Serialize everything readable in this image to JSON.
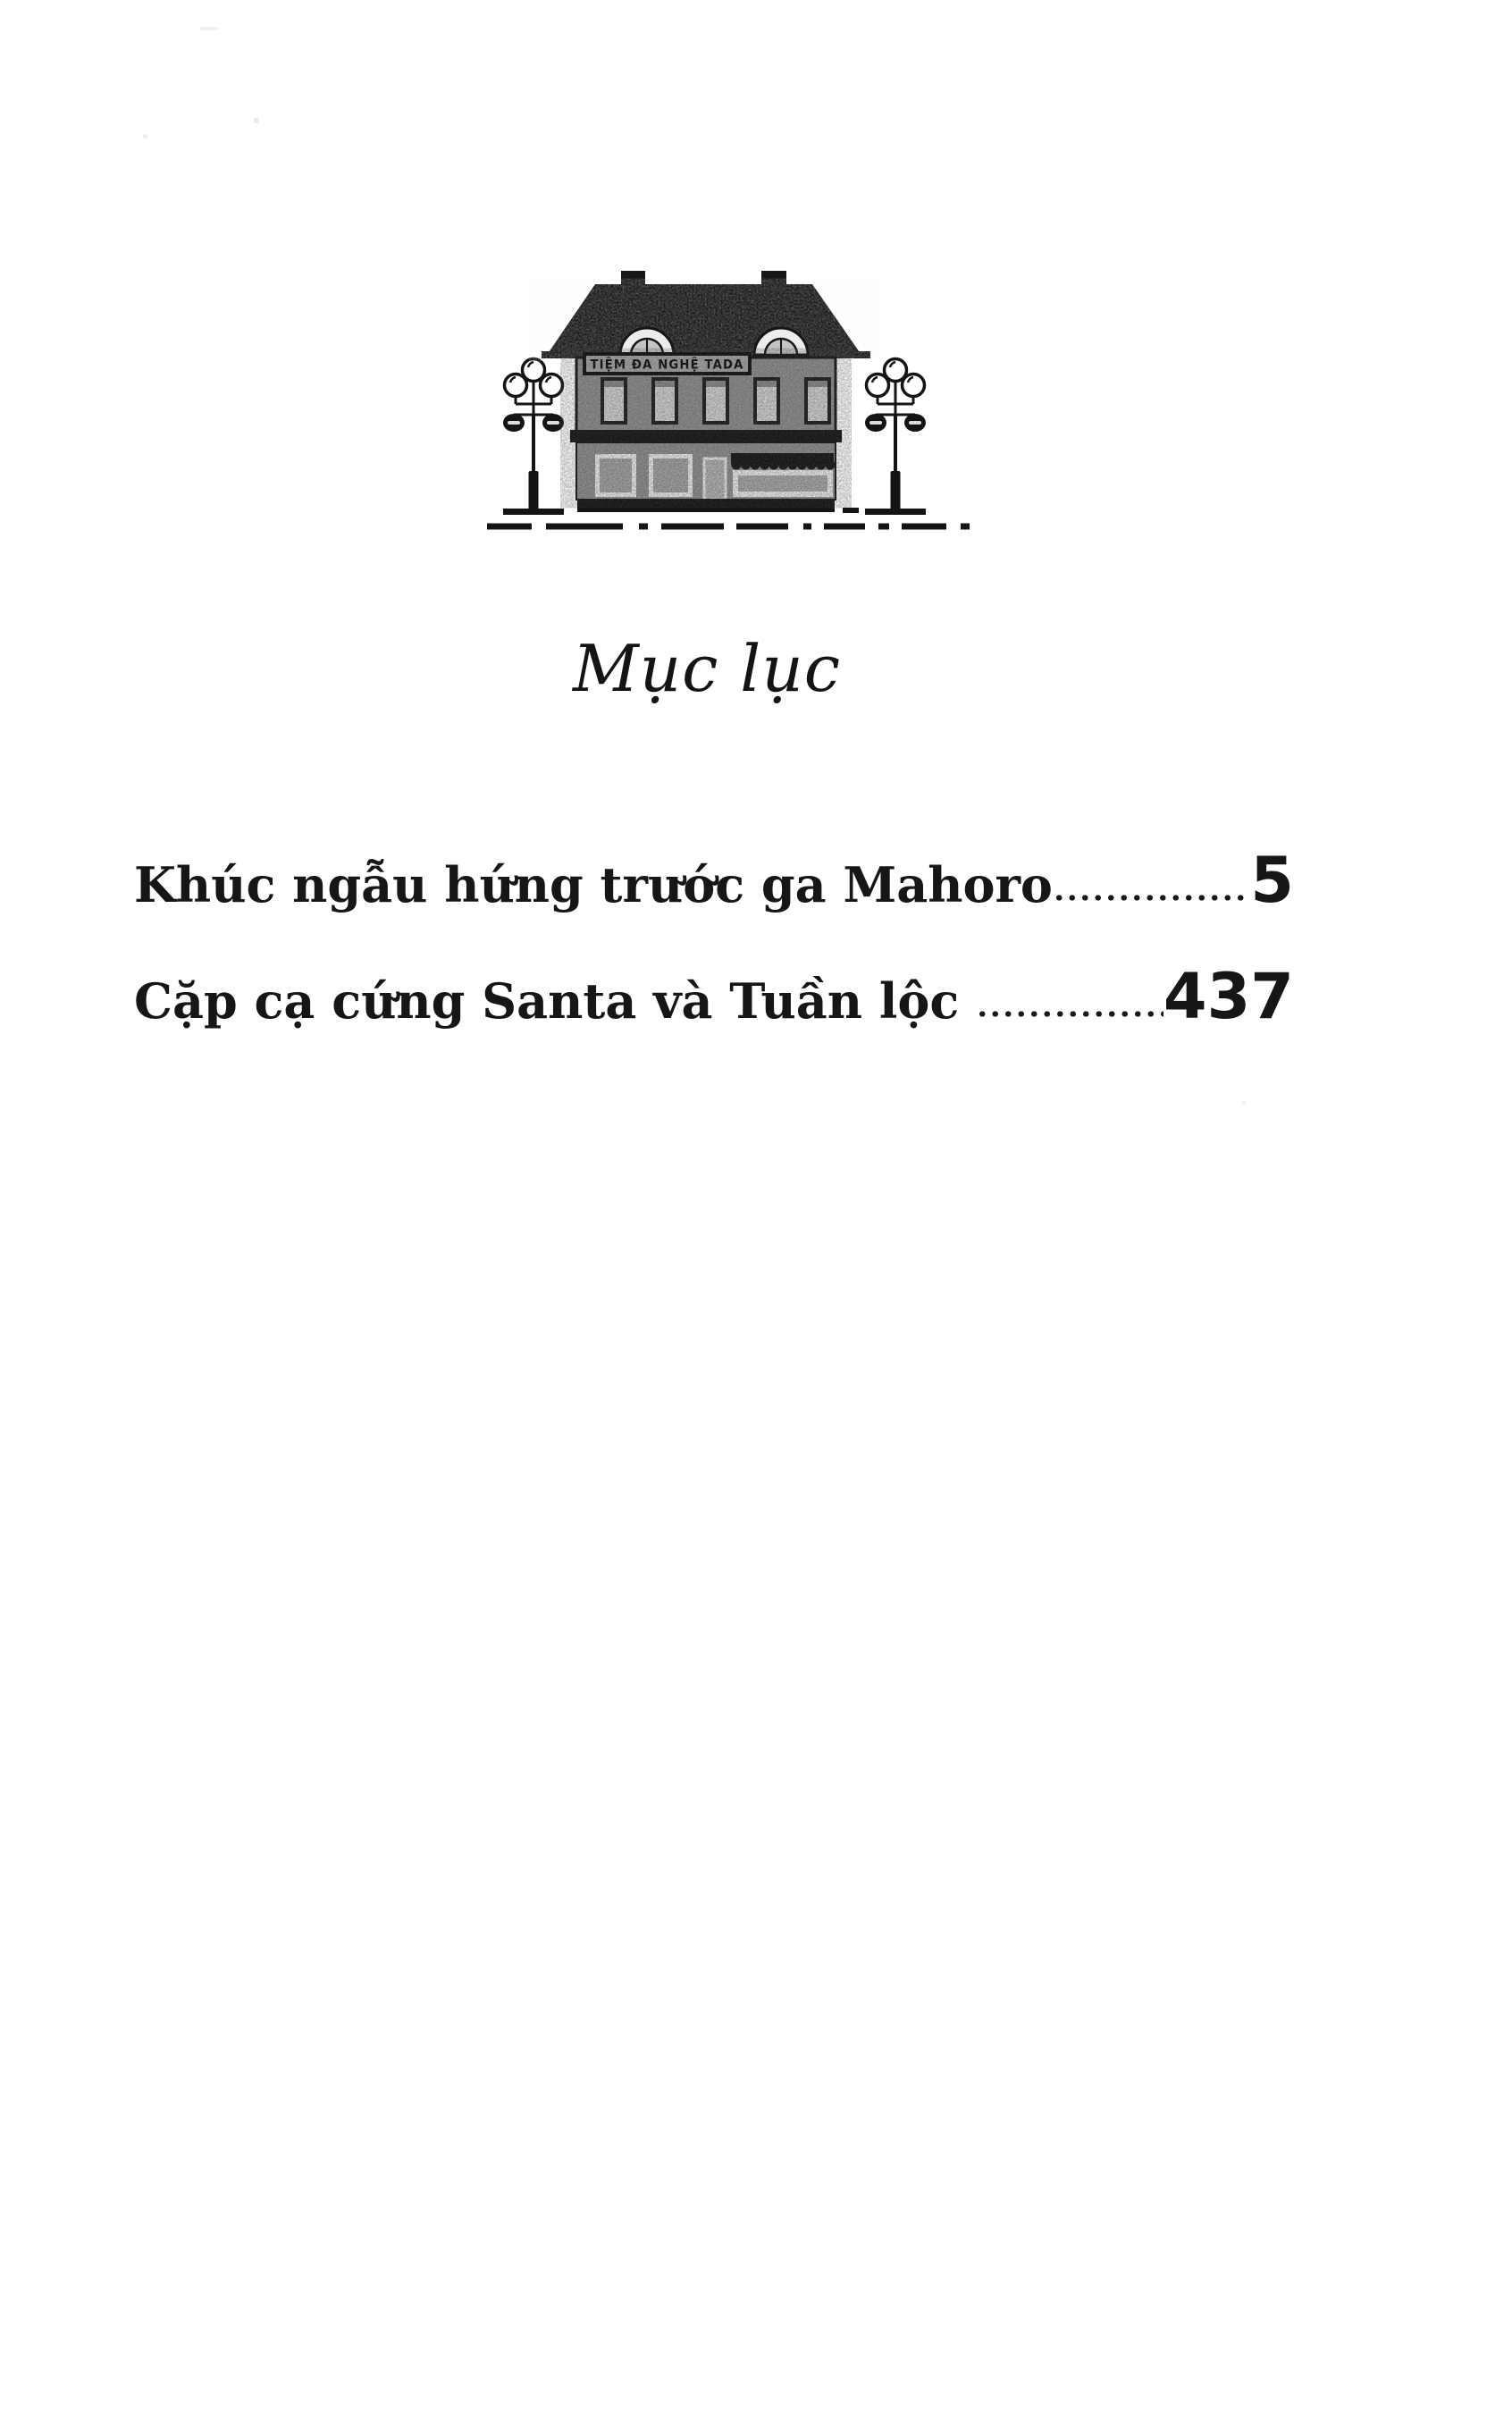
{
  "page": {
    "title": "Mục lục",
    "paper_color": "#ffffff",
    "ink_color": "#161616"
  },
  "illustration": {
    "sign_text": "TIỆM ĐA NGHỆ TADA"
  },
  "toc": {
    "entries": [
      {
        "label": "Khúc ngẫu hứng trước ga Mahoro",
        "page": "5"
      },
      {
        "label": "Cặp cạ cứng Santa và Tuần lộc ",
        "page": "437"
      }
    ]
  }
}
